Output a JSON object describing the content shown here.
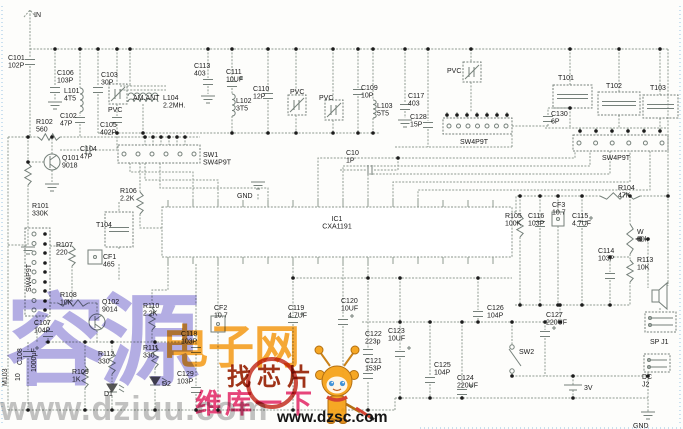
{
  "schematic": {
    "colors": {
      "wire": "#8f9a90",
      "label_text": "#1b1b1b",
      "edge_dots": "#a8cde8",
      "watermark_purple": "#a098e0",
      "watermark_orange": "#f69d1c",
      "watermark_red": "#e8457c",
      "badge_red": "#c63022"
    },
    "ic": {
      "ref": "IC1",
      "part": "CXA1191"
    },
    "labels": [
      {
        "lines": [
          "IN"
        ],
        "x": 34,
        "y": 17
      },
      {
        "lines": [
          "C101",
          "102P"
        ],
        "x": 8,
        "y": 60
      },
      {
        "lines": [
          "C106",
          "103P"
        ],
        "x": 57,
        "y": 75
      },
      {
        "lines": [
          "L101",
          "4T5"
        ],
        "x": 64,
        "y": 93
      },
      {
        "lines": [
          "C103",
          "30P"
        ],
        "x": 101,
        "y": 77
      },
      {
        "lines": [
          "PVC"
        ],
        "x": 108,
        "y": 112
      },
      {
        "lines": [
          "AM.ANT"
        ],
        "x": 133,
        "y": 100
      },
      {
        "lines": [
          "L104",
          "2.2MH."
        ],
        "x": 163,
        "y": 100
      },
      {
        "lines": [
          "C102",
          "47P"
        ],
        "x": 60,
        "y": 118
      },
      {
        "lines": [
          "R102",
          "560"
        ],
        "x": 36,
        "y": 124
      },
      {
        "lines": [
          "C105",
          "402P"
        ],
        "x": 100,
        "y": 127
      },
      {
        "lines": [
          "C113",
          "403"
        ],
        "x": 194,
        "y": 68
      },
      {
        "lines": [
          "C111",
          "10UF"
        ],
        "x": 226,
        "y": 74
      },
      {
        "lines": [
          "L102",
          "3T5"
        ],
        "x": 236,
        "y": 103
      },
      {
        "lines": [
          "C110",
          "12P"
        ],
        "x": 253,
        "y": 91
      },
      {
        "lines": [
          "PVC"
        ],
        "x": 290,
        "y": 94
      },
      {
        "lines": [
          "PVC"
        ],
        "x": 319,
        "y": 100
      },
      {
        "lines": [
          "C109",
          "10P"
        ],
        "x": 361,
        "y": 90
      },
      {
        "lines": [
          "L103",
          "5T5"
        ],
        "x": 377,
        "y": 108
      },
      {
        "lines": [
          "C117",
          "403"
        ],
        "x": 408,
        "y": 98
      },
      {
        "lines": [
          "C128",
          "15P"
        ],
        "x": 410,
        "y": 119
      },
      {
        "lines": [
          "PVC"
        ],
        "x": 447,
        "y": 73
      },
      {
        "lines": [
          "SW4P9T"
        ],
        "x": 460,
        "y": 144
      },
      {
        "lines": [
          "T101"
        ],
        "x": 558,
        "y": 80
      },
      {
        "lines": [
          "C130",
          "6P"
        ],
        "x": 551,
        "y": 116
      },
      {
        "lines": [
          "T102"
        ],
        "x": 606,
        "y": 88
      },
      {
        "lines": [
          "T103"
        ],
        "x": 650,
        "y": 90
      },
      {
        "lines": [
          "SW4P9T"
        ],
        "x": 602,
        "y": 160
      },
      {
        "lines": [
          "SW1",
          "SW4P9T"
        ],
        "x": 203,
        "y": 157
      },
      {
        "lines": [
          "C10",
          "1P"
        ],
        "x": 346,
        "y": 155
      },
      {
        "lines": [
          "GND"
        ],
        "x": 237,
        "y": 198
      },
      {
        "lines": [
          "Q101",
          "9018"
        ],
        "x": 62,
        "y": 160
      },
      {
        "lines": [
          "C104",
          "47P"
        ],
        "x": 80,
        "y": 151
      },
      {
        "lines": [
          "R101",
          "330K"
        ],
        "x": 32,
        "y": 208
      },
      {
        "lines": [
          "R106",
          "2.2K"
        ],
        "x": 120,
        "y": 193
      },
      {
        "lines": [
          "T104"
        ],
        "x": 96,
        "y": 227
      },
      {
        "lines": [
          "CF1",
          "465"
        ],
        "x": 103,
        "y": 259
      },
      {
        "lines": [
          "R107",
          "220"
        ],
        "x": 56,
        "y": 247
      },
      {
        "lines": [
          "SW4P9T"
        ],
        "x": 31,
        "y": 292,
        "rot": -90
      },
      {
        "lines": [
          "R108",
          "10K"
        ],
        "x": 60,
        "y": 297
      },
      {
        "lines": [
          "Q102",
          "9014"
        ],
        "x": 102,
        "y": 304
      },
      {
        "lines": [
          "R110",
          "2.2K"
        ],
        "x": 143,
        "y": 308
      },
      {
        "lines": [
          "C107",
          "104P"
        ],
        "x": 34,
        "y": 325
      },
      {
        "lines": [
          "C108"
        ],
        "x": 22,
        "y": 365,
        "rot": -90
      },
      {
        "lines": [
          "1000μF"
        ],
        "x": 36,
        "y": 372,
        "rot": -90
      },
      {
        "lines": [
          "M103"
        ],
        "x": 7,
        "y": 386,
        "rot": -90
      },
      {
        "lines": [
          "10"
        ],
        "x": 20,
        "y": 381,
        "rot": -90
      },
      {
        "lines": [
          "R112",
          "330"
        ],
        "x": 98,
        "y": 356
      },
      {
        "lines": [
          "R111",
          "330"
        ],
        "x": 143,
        "y": 350
      },
      {
        "lines": [
          "R109",
          "1K"
        ],
        "x": 72,
        "y": 374
      },
      {
        "lines": [
          "D1"
        ],
        "x": 104,
        "y": 396
      },
      {
        "lines": [
          "D2"
        ],
        "x": 162,
        "y": 386
      },
      {
        "lines": [
          "CF2",
          "10.7"
        ],
        "x": 214,
        "y": 310
      },
      {
        "lines": [
          "C118",
          "103P"
        ],
        "x": 181,
        "y": 336
      },
      {
        "lines": [
          "C129",
          "103P"
        ],
        "x": 177,
        "y": 376
      },
      {
        "lines": [
          "C119",
          "4.7UF"
        ],
        "x": 288,
        "y": 310
      },
      {
        "lines": [
          "C120",
          "10UF"
        ],
        "x": 341,
        "y": 303
      },
      {
        "lines": [
          "C122",
          "223p"
        ],
        "x": 365,
        "y": 336
      },
      {
        "lines": [
          "C121",
          "153P"
        ],
        "x": 365,
        "y": 363
      },
      {
        "lines": [
          "C123",
          "10UF"
        ],
        "x": 388,
        "y": 333
      },
      {
        "lines": [
          "C126",
          "104P"
        ],
        "x": 487,
        "y": 310
      },
      {
        "lines": [
          "C127",
          "220UF"
        ],
        "x": 546,
        "y": 317
      },
      {
        "lines": [
          "C125",
          "104P"
        ],
        "x": 434,
        "y": 367
      },
      {
        "lines": [
          "C124",
          "220UF"
        ],
        "x": 457,
        "y": 380
      },
      {
        "lines": [
          "SW2"
        ],
        "x": 519,
        "y": 354
      },
      {
        "lines": [
          "3V"
        ],
        "x": 584,
        "y": 390
      },
      {
        "lines": [
          "SP J1"
        ],
        "x": 650,
        "y": 344
      },
      {
        "lines": [
          "DC",
          "J2"
        ],
        "x": 642,
        "y": 379
      },
      {
        "lines": [
          "GND"
        ],
        "x": 633,
        "y": 428
      },
      {
        "lines": [
          "R105",
          "100K"
        ],
        "x": 505,
        "y": 218
      },
      {
        "lines": [
          "C116",
          "103P"
        ],
        "x": 528,
        "y": 218
      },
      {
        "lines": [
          "CF3",
          "10.7"
        ],
        "x": 552,
        "y": 207
      },
      {
        "lines": [
          "C115",
          "4.7UF"
        ],
        "x": 572,
        "y": 218
      },
      {
        "lines": [
          "R104",
          "47K"
        ],
        "x": 618,
        "y": 190
      },
      {
        "lines": [
          "W",
          "50k"
        ],
        "x": 637,
        "y": 234
      },
      {
        "lines": [
          "R113",
          "10K"
        ],
        "x": 637,
        "y": 262
      },
      {
        "lines": [
          "C114",
          "103P"
        ],
        "x": 598,
        "y": 253
      },
      {
        "lines": [
          "IC1",
          "CXA1191"
        ],
        "x": 337,
        "y": 221,
        "anchor": "middle"
      }
    ]
  },
  "watermarks": {
    "purple_brand": "容源",
    "orange_brand": "电子网",
    "badge_text": "找芯片",
    "red_slogan": "维库一下",
    "url_gray": "www.dziuu.com",
    "url_black": "www.dzsc.com"
  }
}
